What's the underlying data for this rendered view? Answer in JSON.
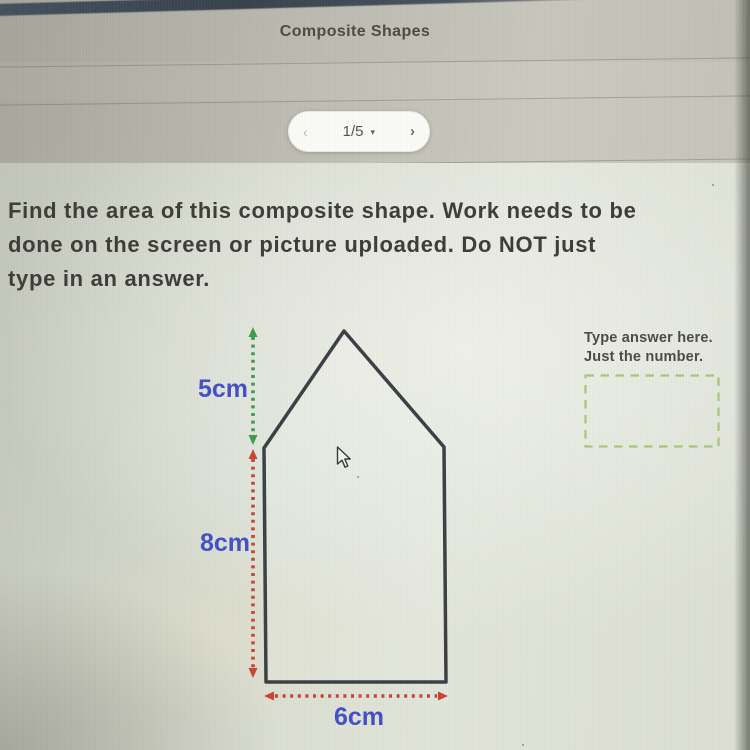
{
  "header": {
    "title": "Composite Shapes"
  },
  "pagination": {
    "prev": "‹",
    "page": "1/5",
    "dropdown": "▾",
    "next": "›"
  },
  "question": {
    "lines": [
      "Find the area of this composite shape. Work needs to be",
      "done on the screen or picture uploaded. Do NOT just",
      "type in an answer."
    ]
  },
  "figure": {
    "labels": {
      "triangle_height": "5cm",
      "rectangle_height": "8cm",
      "base_width": "6cm"
    },
    "colors": {
      "outline": "#3b4044",
      "triangle_dim": "#3c9e4d",
      "rect_dim": "#cb4434",
      "label": "#4350c8"
    }
  },
  "answer_panel": {
    "instructions": [
      "Type answer here.",
      "Just the number."
    ],
    "value": "",
    "box_border": "#a9c77c"
  }
}
